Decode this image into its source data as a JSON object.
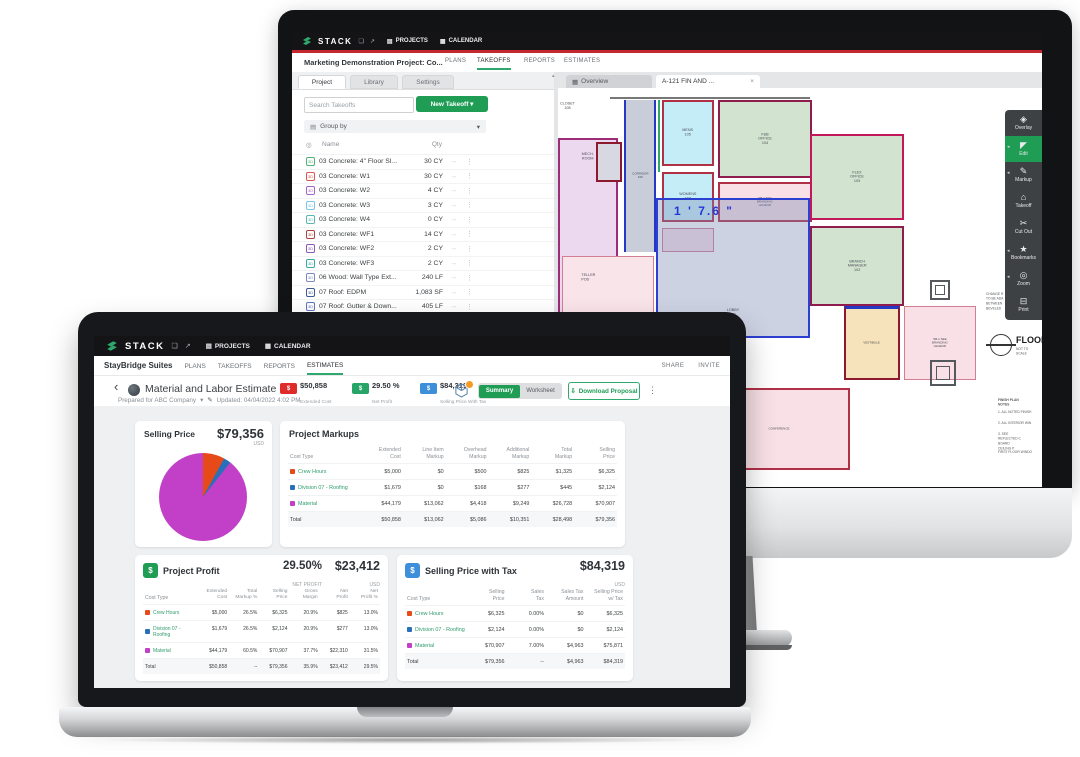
{
  "monitor": {
    "topbar": {
      "brand": "STACK",
      "fullscreen_icon": "❏",
      "popout_icon": "↗",
      "projects_icon": "▤",
      "projects_label": "PROJECTS",
      "calendar_icon": "▦",
      "calendar_label": "CALENDAR"
    },
    "accent_red": "#c3282e",
    "project_bar": {
      "title": "Marketing Demonstration Project: Co...",
      "tabs": [
        "PLANS",
        "TAKEOFFS",
        "REPORTS",
        "ESTIMATES"
      ]
    },
    "left_panel": {
      "tabs": [
        "Project",
        "Library",
        "Settings"
      ],
      "search_placeholder": "Search Takeoffs",
      "new_takeoff_label": "New Takeoff ▾",
      "group_icon": "▤",
      "group_label": "Group by",
      "group_caret": "▾",
      "eye_icon": "◎",
      "col_name": "Name",
      "col_qty": "Qty",
      "icon_text": "3D",
      "row_arrow": "→",
      "row_menu": "⋮",
      "rows": [
        {
          "name": "03 Concrete: 4\" Floor Sl...",
          "qty": "30 CY",
          "color": "#51b27a"
        },
        {
          "name": "03 Concrete: W1",
          "qty": "30 CY",
          "color": "#d95550"
        },
        {
          "name": "03 Concrete: W2",
          "qty": "4 CY",
          "color": "#a765c9"
        },
        {
          "name": "03 Concrete: W3",
          "qty": "3 CY",
          "color": "#7cc4e8"
        },
        {
          "name": "03 Concrete: W4",
          "qty": "0 CY",
          "color": "#58b8b0"
        },
        {
          "name": "03 Concrete: WF1",
          "qty": "14 CY",
          "color": "#a8433f"
        },
        {
          "name": "03 Concrete: WF2",
          "qty": "2 CY",
          "color": "#8e56b8"
        },
        {
          "name": "03 Concrete: WF3",
          "qty": "2 CY",
          "color": "#3aa7a0"
        },
        {
          "name": "06 Wood: Wall Type Ext...",
          "qty": "240 LF",
          "color": "#7b88c2"
        },
        {
          "name": "07 Roof: EDPM",
          "qty": "1,083 SF",
          "color": "#3d5a96"
        },
        {
          "name": "07 Roof: Gutter & Down...",
          "qty": "405 LF",
          "color": "#5d74c4"
        },
        {
          "name": "07 Roof: Hip",
          "qty": "93 LF",
          "color": "#7cd0ef"
        }
      ]
    },
    "plan_dock": {
      "overview_icon": "▦",
      "overview_label": "Overview",
      "sheet_label": "A-121 FIN AND ...",
      "close_icon": "×",
      "scroll_up_icon": "▴"
    },
    "toolbar": [
      {
        "icon": "◈",
        "label": "Overlay"
      },
      {
        "icon": "◤",
        "label": "Edit"
      },
      {
        "icon": "✎",
        "label": "Markup"
      },
      {
        "icon": "⌂",
        "label": "Takeoff"
      },
      {
        "icon": "✂",
        "label": "Cut Out"
      },
      {
        "icon": "★",
        "label": "Bookmarks"
      },
      {
        "icon": "◎",
        "label": "Zoom"
      },
      {
        "icon": "⊟",
        "label": "Print"
      }
    ],
    "plan": {
      "dimension": "1 ' 7.6 \"",
      "labels": {
        "closet": "CLOSET\n108",
        "mech": "MECH.\nROOM",
        "corridor": "CORRIDOR\n106",
        "mens": "MENS\n105",
        "womens": "WOMENS\n107",
        "fb_office": "F&B\nOFFICE\n104",
        "flex_office": "FLEX\nOFFICE\n103",
        "branch_manager": "BRANCH\nMANAGER\n102",
        "teller": "TELLER\nPOD",
        "lobby": "LOBBY\n101",
        "vestibule": "VESTIBULE",
        "conference": "CONFERENCE",
        "branding_1": "SB-1 SEE\nBRANDING\nLEGEND",
        "branding_2": "SB-1 SEE\nBRANDING\nLEGEND",
        "side_note": "CHANGE R\nTO BE ADA\nBETWEEN\nBEVELED",
        "floor_title": "FLOOR",
        "not_to_scale": "NOT TO SCALE",
        "notes_title": "FINISH PLAN NOTES",
        "note_1": "1.  ALL NOTED FINISH",
        "note_2": "2.  ALL INTERIOR WIN",
        "note_3": "3.  SEE REFLECTED C\n     BOARD CEILING P",
        "notes_footer": "FIRST FLOOR WINDO"
      }
    }
  },
  "laptop": {
    "topbar": {
      "brand": "STACK",
      "fullscreen_icon": "❏",
      "popout_icon": "↗",
      "projects_icon": "▤",
      "projects_label": "PROJECTS",
      "calendar_icon": "▦",
      "calendar_label": "CALENDAR"
    },
    "project_bar": {
      "title": "StayBridge Suites",
      "tabs": [
        "PLANS",
        "TAKEOFFS",
        "REPORTS",
        "ESTIMATES"
      ],
      "share_label": "SHARE",
      "invite_label": "INVITE"
    },
    "header": {
      "back_icon": "‹",
      "title": "Material and Labor Estimate",
      "prepared": "Prepared for ABC Company",
      "prepared_caret": "▾",
      "edit_icon": "✎",
      "updated": "Updated: 04/04/2022 4:02 PM",
      "stats": [
        {
          "value": "$50,858",
          "label": "Extended Cost",
          "color": "#e02b2b",
          "icon_text": "$"
        },
        {
          "value": "29.50 %",
          "label": "Net Profit",
          "color": "#27a567",
          "icon_text": "$"
        },
        {
          "value": "$84,319",
          "label": "Selling Price With Tax",
          "color": "#3d8fd9",
          "icon_text": "$"
        }
      ],
      "toggle": {
        "summary": "Summary",
        "worksheet": "Worksheet"
      },
      "download_icon": "⇩",
      "download_label": "Download Proposal",
      "menu_icon": "⋮"
    },
    "selling_price_card": {
      "title": "Selling Price",
      "value": "$79,356",
      "currency": "USD"
    },
    "chart_data": {
      "type": "pie",
      "title": "Selling Price",
      "total": "$79,356",
      "currency": "USD",
      "legend_position": "none",
      "slices": [
        {
          "label": "Crew Hours",
          "value": 6325,
          "color": "#e64a19"
        },
        {
          "label": "Division 07 - Roofing",
          "value": 2124,
          "color": "#2a6fba"
        },
        {
          "label": "Material",
          "value": 70907,
          "color": "#c240c8"
        }
      ]
    },
    "project_markups": {
      "title": "Project Markups",
      "col_cost_type": "Cost Type",
      "columns": [
        "Extended\nCost",
        "Line Item\nMarkup",
        "Overhead\nMarkup",
        "Additional\nMarkup",
        "Total\nMarkup",
        "Selling\nPrice"
      ],
      "rows": [
        {
          "cost_type": "Crew Hours",
          "color": "#e64a19",
          "values": [
            "$5,000",
            "$0",
            "$500",
            "$825",
            "$1,325",
            "$6,325"
          ]
        },
        {
          "cost_type": "Division 07 - Roofing",
          "color": "#2a6fba",
          "values": [
            "$1,679",
            "$0",
            "$168",
            "$277",
            "$445",
            "$2,124"
          ]
        },
        {
          "cost_type": "Material",
          "color": "#c240c8",
          "values": [
            "$44,179",
            "$13,062",
            "$4,418",
            "$9,249",
            "$26,728",
            "$70,907"
          ]
        }
      ],
      "total_label": "Total",
      "total_values": [
        "$50,858",
        "$13,062",
        "$5,086",
        "$10,351",
        "$28,498",
        "$79,356"
      ]
    },
    "project_profit": {
      "title": "Project Profit",
      "icon_text": "$",
      "icon_color": "#1f9d55",
      "pct": "29.50%",
      "pct_label": "NET PROFIT",
      "value": "$23,412",
      "currency": "USD",
      "col_cost_type": "Cost Type",
      "columns": [
        "Extended\nCost",
        "Total\nMarkup %",
        "Selling\nPrice",
        "Gross\nMargin",
        "Net\nProfit",
        "Net\nProfit %"
      ],
      "rows": [
        {
          "cost_type": "Crew Hours",
          "color": "#e64a19",
          "values": [
            "$5,000",
            "26.5%",
            "$6,325",
            "20.9%",
            "$825",
            "13.0%"
          ]
        },
        {
          "cost_type": "Division 07 - Roofing",
          "color": "#2a6fba",
          "values": [
            "$1,679",
            "26.5%",
            "$2,124",
            "20.9%",
            "$277",
            "13.0%"
          ]
        },
        {
          "cost_type": "Material",
          "color": "#c240c8",
          "values": [
            "$44,179",
            "60.5%",
            "$70,907",
            "37.7%",
            "$22,310",
            "31.5%"
          ]
        }
      ],
      "total_label": "Total",
      "total_values": [
        "$50,858",
        "--",
        "$79,356",
        "35.9%",
        "$23,412",
        "29.5%"
      ]
    },
    "selling_price_tax": {
      "title": "Selling Price with Tax",
      "icon_text": "$",
      "icon_color": "#3d8fd9",
      "value": "$84,319",
      "currency": "USD",
      "col_cost_type": "Cost Type",
      "columns": [
        "Selling\nPrice",
        "Sales\nTax",
        "Sales Tax\nAmount",
        "Selling Price\nw/ Tax"
      ],
      "rows": [
        {
          "cost_type": "Crew Hours",
          "color": "#e64a19",
          "values": [
            "$6,325",
            "0.00%",
            "$0",
            "$6,325"
          ]
        },
        {
          "cost_type": "Division 07 - Roofing",
          "color": "#2a6fba",
          "values": [
            "$2,124",
            "0.00%",
            "$0",
            "$2,124"
          ]
        },
        {
          "cost_type": "Material",
          "color": "#c240c8",
          "values": [
            "$70,907",
            "7.00%",
            "$4,963",
            "$75,871"
          ]
        }
      ],
      "total_label": "Total",
      "total_values": [
        "$79,356",
        "--",
        "$4,963",
        "$84,319"
      ]
    }
  }
}
